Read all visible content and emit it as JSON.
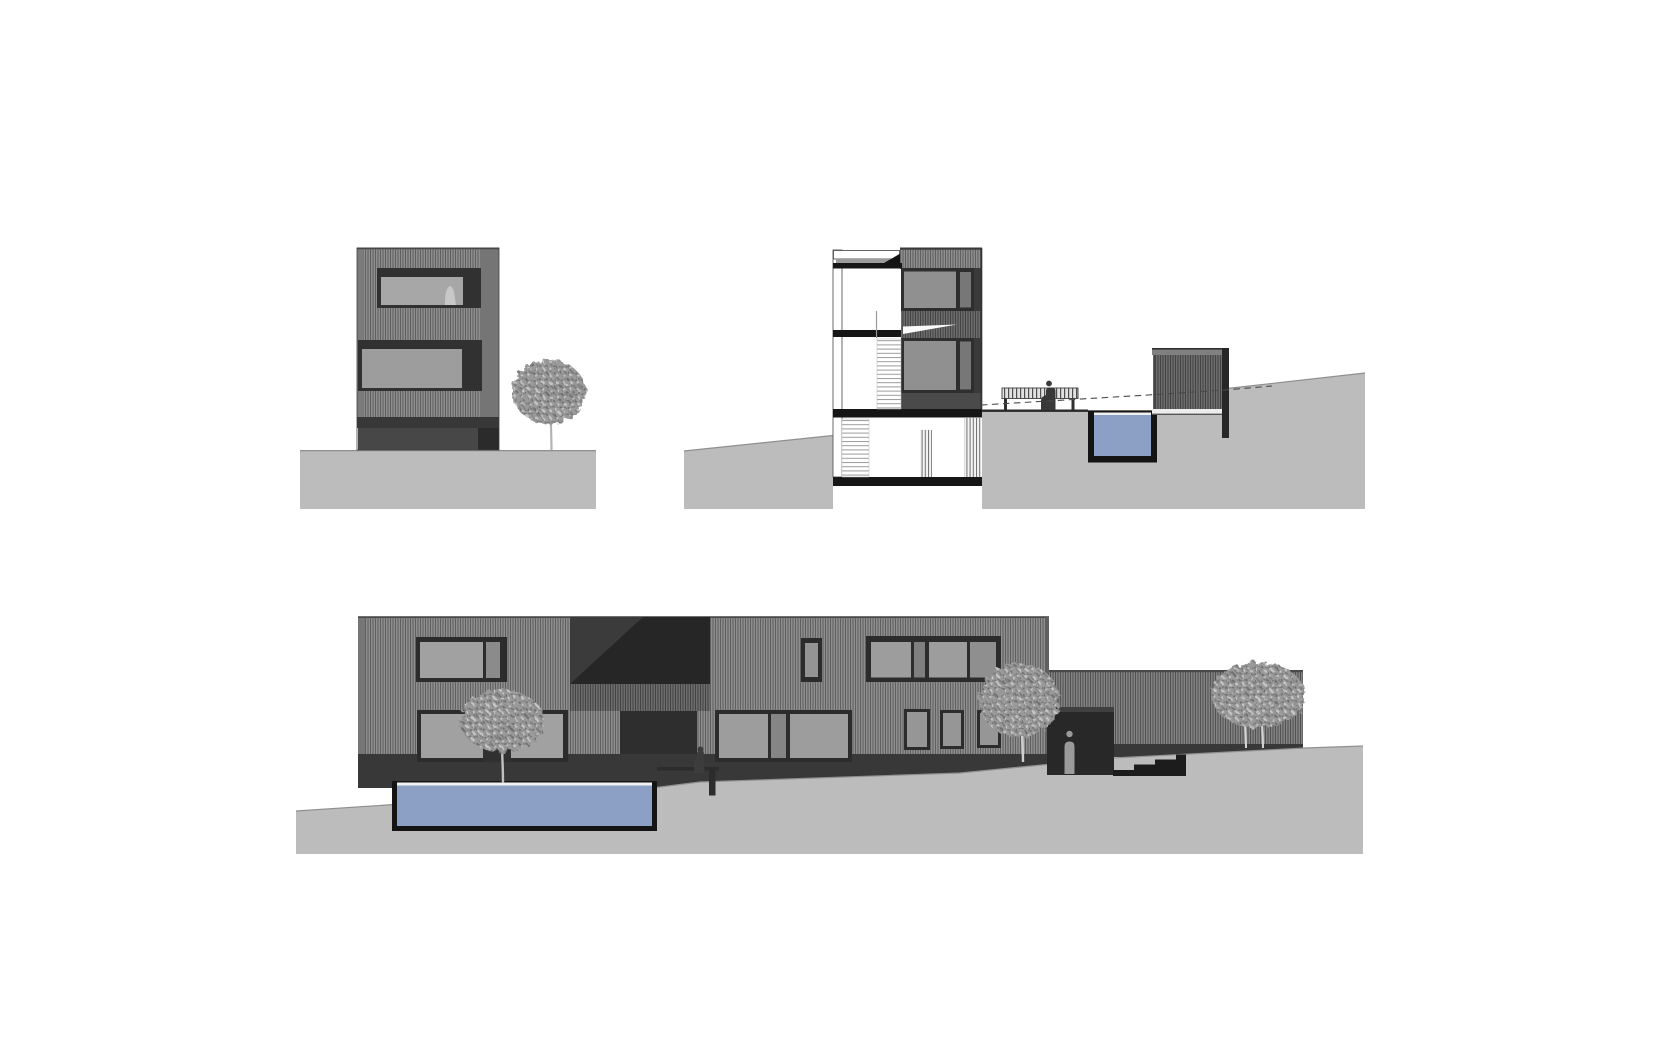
{
  "sheet": {
    "type": "architectural-drawing-sheet",
    "background": "#ffffff",
    "width": 1680,
    "height": 1050
  },
  "colors": {
    "ground": "#bcbcbc",
    "ground_edge": "#8f8f8f",
    "cladding_base": "#8e8e8e",
    "cladding_stripe": "#5f5f5f",
    "cladding_dark_base": "#6d6d6d",
    "cladding_dark_stripe": "#434343",
    "cladding_wing_base": "#828282",
    "cladding_wing_stripe": "#525252",
    "window_frame": "#2d2d2d",
    "pane_light": "#a1a1a1",
    "pane_mid": "#909090",
    "pane_dark": "#777777",
    "slab_black": "#161616",
    "recess_dark": "#282828",
    "base_band": "#383838",
    "pool_rim": "#141414",
    "pool_water": "#8c9fc5",
    "pool_waterline": "#f1f1f1",
    "tree_trunk": "#bdbdbd",
    "figure_dark": "#3c3c3c",
    "figure_light": "#9a9a9a",
    "interior_white": "#ffffff",
    "grade_dash": "#4a4a4a"
  },
  "drawings": [
    {
      "id": "end-elevation",
      "name": "end elevation",
      "windows": 2,
      "trees": 1,
      "figures": 1
    },
    {
      "id": "cross-section",
      "name": "cross section",
      "floor_slabs": 4,
      "stairs": 2,
      "pool": true,
      "bench": true,
      "outbuilding": true,
      "figures": 1
    },
    {
      "id": "garden-elevation",
      "name": "garden elevation",
      "windows": 9,
      "trees": 3,
      "pool": true,
      "entrance": true,
      "figures": 2
    }
  ]
}
